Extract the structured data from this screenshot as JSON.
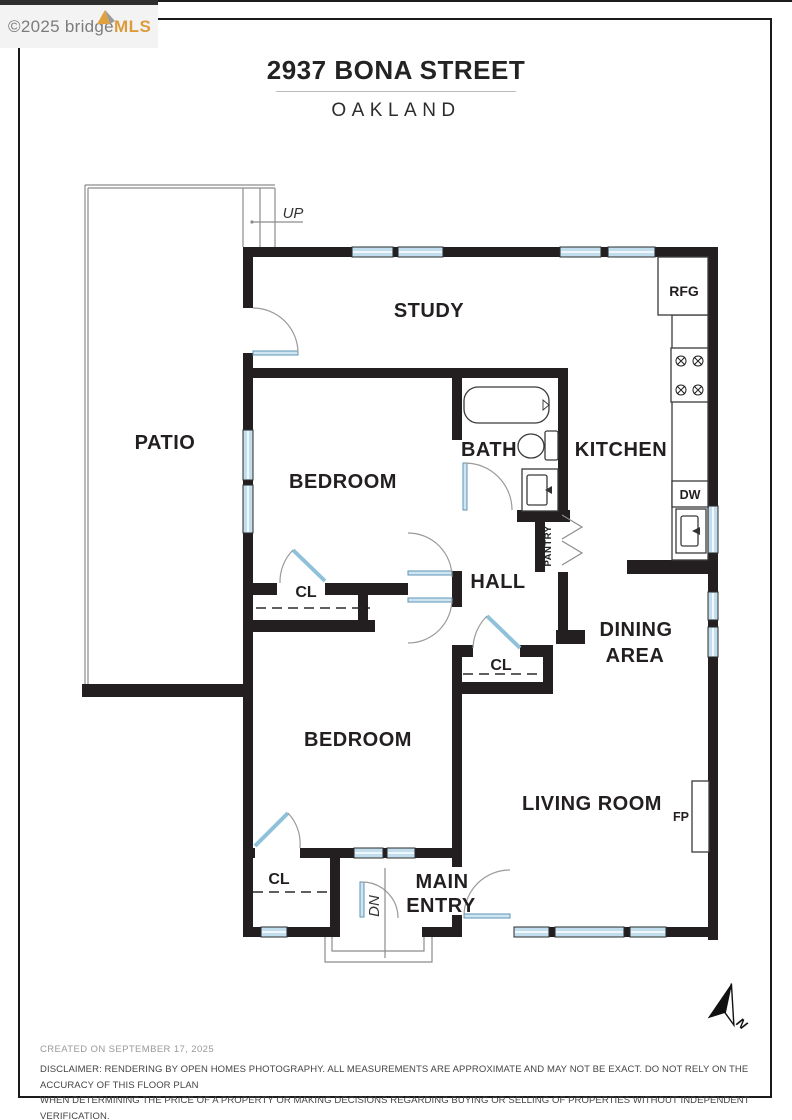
{
  "watermark": {
    "copyright": "©2025 bridge",
    "brand": "MLS"
  },
  "header": {
    "title": "2937 BONA STREET",
    "subtitle": "OAKLAND"
  },
  "floorplan": {
    "labels": {
      "study": "STUDY",
      "patio": "PATIO",
      "bedroom_upper": "BEDROOM",
      "bath": "BATH",
      "kitchen": "KITCHEN",
      "hall": "HALL",
      "dining1": "DINING",
      "dining2": "AREA",
      "bedroom_lower": "BEDROOM",
      "living": "LIVING ROOM",
      "entry1": "MAIN",
      "entry2": "ENTRY",
      "closet": "CL",
      "pantry": "PANTRY",
      "rfg": "RFG",
      "dw": "DW",
      "fp": "FP",
      "up": "UP",
      "dn": "DN",
      "north": "N"
    }
  },
  "footer": {
    "created": "CREATED ON SEPTEMBER 17, 2025",
    "disclaimer1": "DISCLAIMER: RENDERING BY OPEN HOMES PHOTOGRAPHY. ALL MEASUREMENTS ARE APPROXIMATE AND MAY NOT BE EXACT. DO NOT RELY ON THE ACCURACY OF THIS FLOOR PLAN",
    "disclaimer2": "WHEN DETERMINING THE PRICE OF A PROPERTY OR MAKING DECISIONS REGARDING BUYING OR SELLING OF PROPERTIES WITHOUT INDEPENDENT VERIFICATION."
  },
  "colors": {
    "wall": "#231f20",
    "window": "#c2deee",
    "door": "#8fc1da",
    "brand": "#dc9c3c"
  }
}
